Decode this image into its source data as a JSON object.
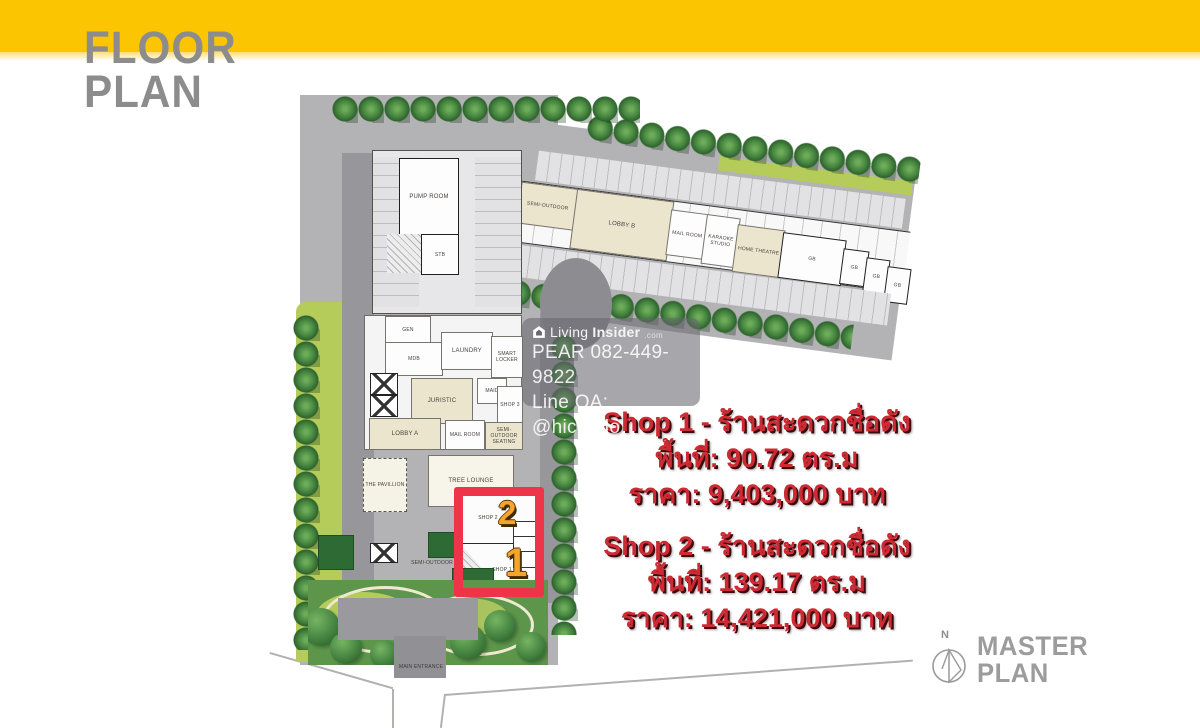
{
  "header": {
    "title_line1": "FLOOR",
    "title_line2": "PLAN"
  },
  "watermark": {
    "brand_prefix": "Living",
    "brand_suffix": "Insider",
    "brand_tld": ".com",
    "phone": "PEAR 082-449-9822",
    "line_oa": "Line OA: @hicondo"
  },
  "listings": {
    "shop1": {
      "title": "Shop 1 - ร้านสะดวกชื่อดัง",
      "area": "พื้นที่: 90.72 ตร.ม",
      "price": "ราคา: 9,403,000 บาท"
    },
    "shop2": {
      "title": "Shop 2 - ร้านสะดวกชื่อดัง",
      "area": "พื้นที่: 139.17 ตร.ม",
      "price": "ราคา: 14,421,000 บาท"
    }
  },
  "plan": {
    "labels": {
      "pump_room": "PUMP ROOM",
      "stb": "STB",
      "semi_outdoor_wing": "SEMI-OUTDOOR",
      "lobby_b": "LOBBY B",
      "mail_room_wing": "MAIL ROOM",
      "karaoke_studio": "KARAOKE STUDIO",
      "home_theatre": "HOME THEATRE",
      "gb_large": "GB",
      "gb_small_1": "GB",
      "gb_small_2": "GB",
      "gb_small_3": "GB",
      "gen": "GEN",
      "mdb": "MDB",
      "laundry": "LAUNDRY",
      "smart_locker": "SMART LOCKER",
      "maid": "MAID",
      "juristic": "JURISTIC",
      "shop_3": "SHOP 3",
      "lobby_a": "LOBBY A",
      "mail_room_tower": "MAIL ROOM",
      "semi_outdoor_seating": "SEMI-OUTDOOR SEATING",
      "the_pavillion": "THE PAVILLION",
      "tree_lounge": "TREE LOUNGE",
      "shop_2": "SHOP 2",
      "shop_1": "SHOP 1",
      "semi_outdoor_lower": "SEMI-OUTDOOR",
      "main_entrance": "MAIN ENTRANCE"
    },
    "highlight": {
      "shop2_number": "2",
      "shop1_number": "1"
    }
  },
  "compass": {
    "north_label": "N"
  },
  "footer_badge": {
    "line1": "MASTER",
    "line2": "PLAN"
  },
  "colors": {
    "banner_yellow": "#FCC502",
    "title_gray": "#8C8C8C",
    "listing_red": "#CE2A33",
    "highlight_red": "#EE3448",
    "number_orange": "#F5A62A"
  }
}
